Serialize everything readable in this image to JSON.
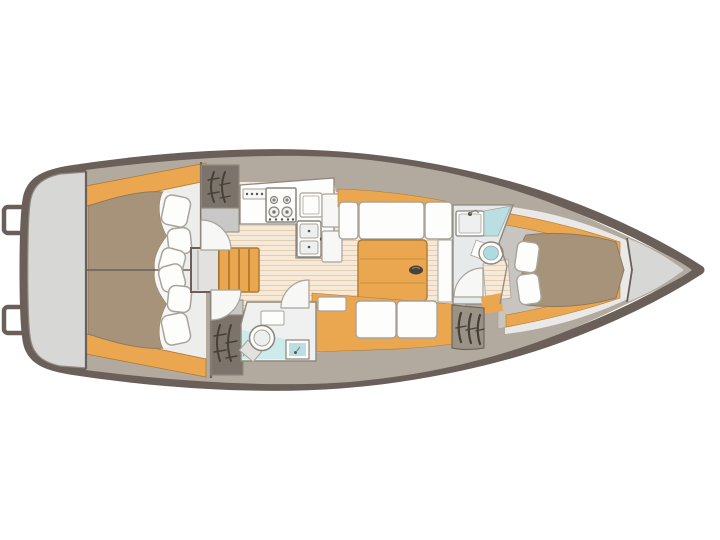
{
  "diagram": {
    "type": "sailboat-interior-floor-plan",
    "orientation": "bow-right",
    "visible_text": "none"
  },
  "colors": {
    "background": "#ffffff",
    "hull": "#6b6059",
    "lining": "#b3aa9f",
    "lazarette": "#d7d7d6",
    "cabinBg": "#ededec",
    "vberthBg": "#eae9e7",
    "entryGray": "#c8c5c1",
    "floor": "#f6e9d8",
    "floorLine": "#e4ceb2",
    "wood": "#eba74f",
    "woodDark": "#b07a2e",
    "mattress": "#a79379",
    "mattressEdge": "#8d7a63",
    "blanket": "#f7f7f5",
    "white": "#fdfdfb",
    "furnitureLine": "#a8a39b",
    "applianceLine": "#8a857d",
    "shelfGray": "#c9c8c6",
    "grayDark": "#8f897f",
    "engineBox": "#e2e1df",
    "locker": "#7c736a",
    "lockerSlat": "#46403a",
    "lockerTaupe": "#9b9286",
    "teal": "#badfe2",
    "tealLight": "#cfeaea",
    "headFloor": "#e7eaea",
    "aftHeadFloor": "#eef1f0",
    "sinkInner": "#eef0ef",
    "tableOval": "#46413b",
    "knobDot": "#555550"
  },
  "fixtures": [
    "transom-swim-steps",
    "lazarette",
    "aft-double-berth-port",
    "aft-double-berth-starboard",
    "berth-pillows",
    "hanging-locker-port",
    "hanging-locker-starboard",
    "engine-box",
    "companionway-stairs",
    "cabin-doors",
    "galley-control-panel",
    "galley-stove-4-burner",
    "galley-sink-cover",
    "galley-double-sink",
    "galley-cabinets",
    "salon-settee-port",
    "salon-settee-starboard",
    "salon-folding-table",
    "aft-head-toilet",
    "aft-head-shower",
    "forward-head-sink",
    "forward-head-toilet",
    "louvered-locker",
    "v-berth-double-bed",
    "v-berth-pillows",
    "anchor-locker"
  ]
}
